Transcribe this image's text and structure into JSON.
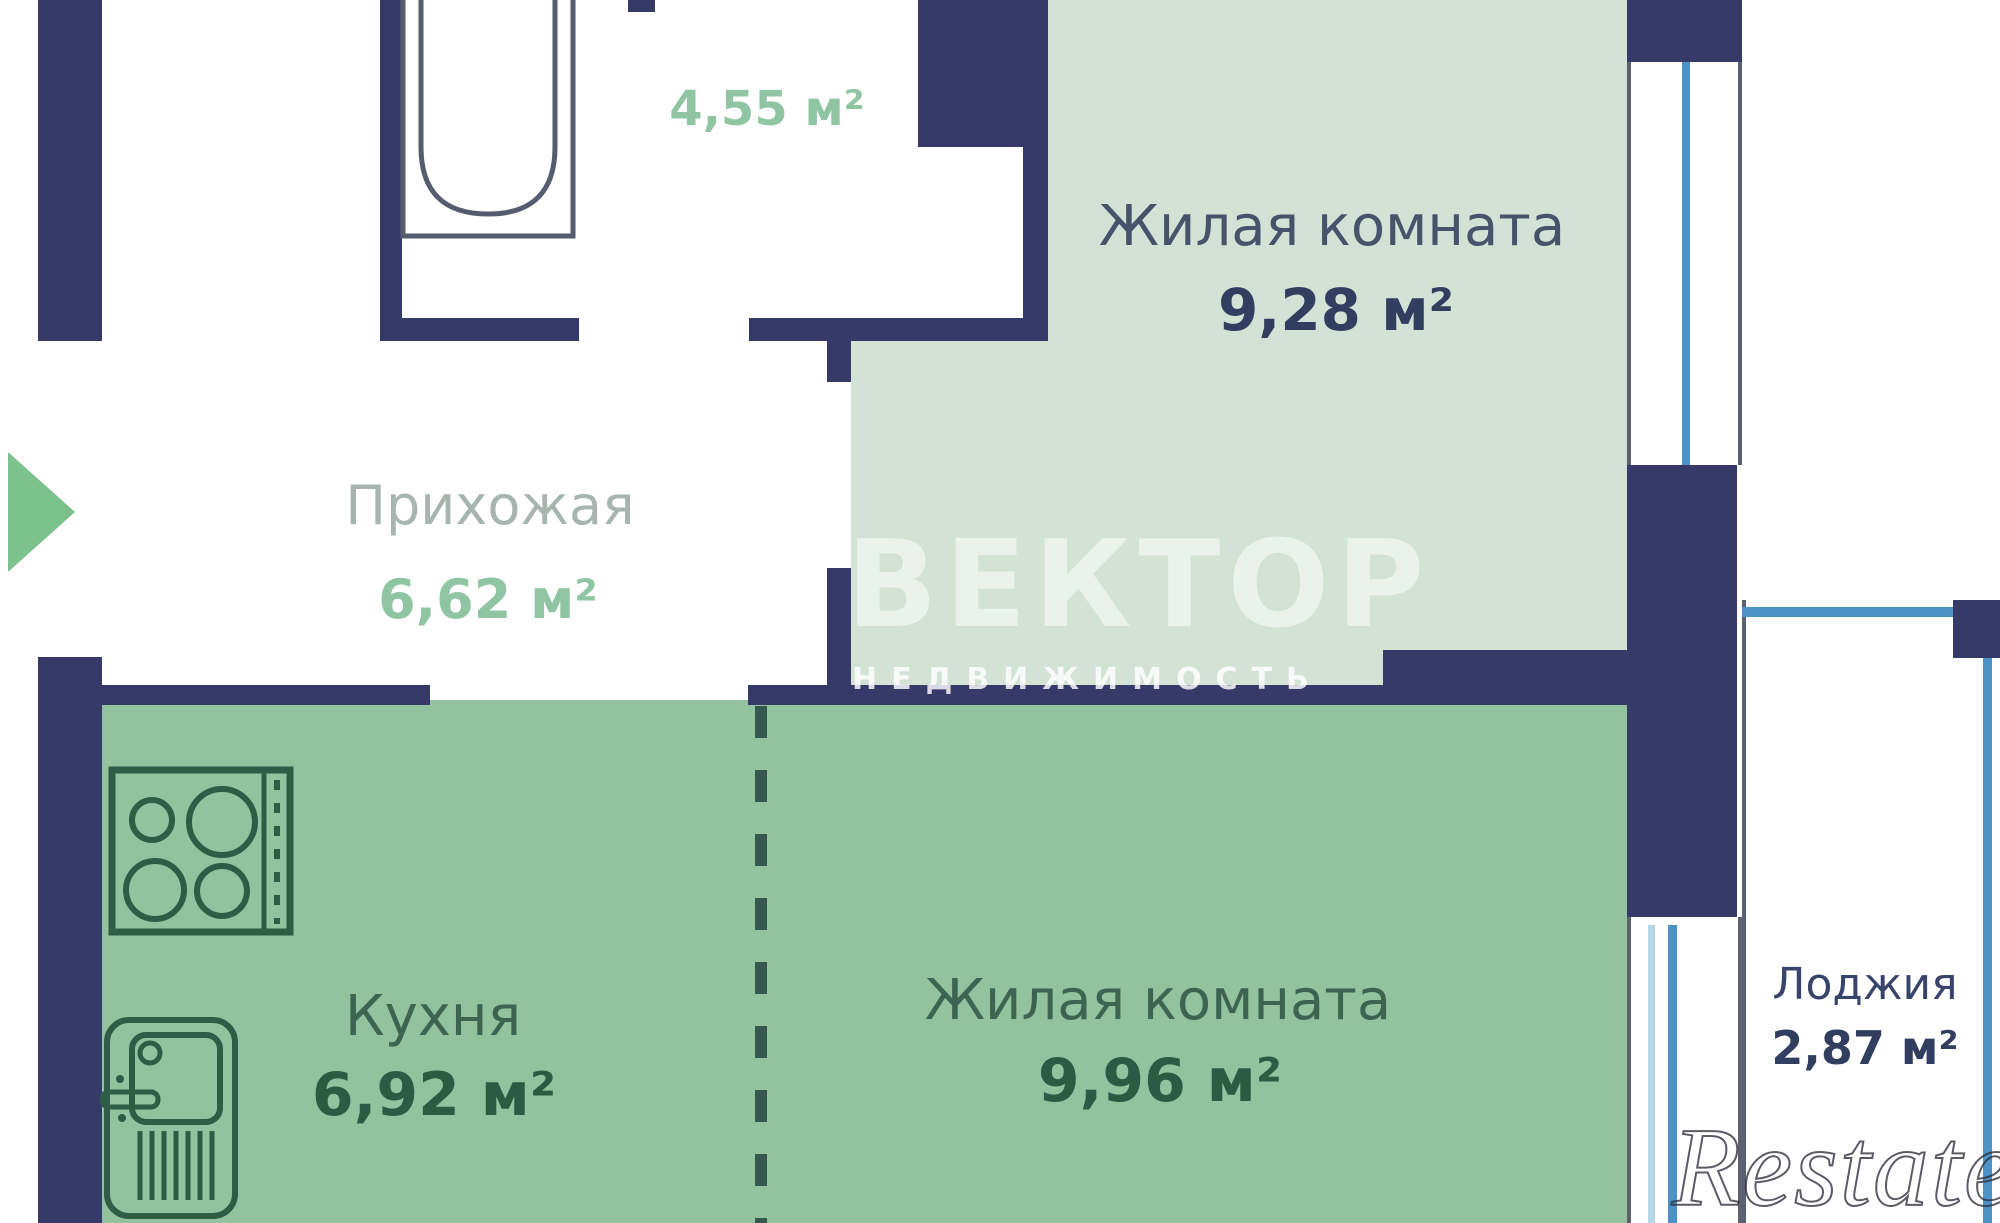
{
  "plan_title": "apartment floor plan",
  "rooms": [
    {
      "id": "bathroom",
      "name": "",
      "area": "4,55 м²"
    },
    {
      "id": "hallway",
      "name": "Прихожая",
      "area": "6,62 м²"
    },
    {
      "id": "living-room-1",
      "name": "Жилая комната",
      "area": "9,28 м²"
    },
    {
      "id": "kitchen",
      "name": "Кухня",
      "area": "6,92 м²"
    },
    {
      "id": "living-room-2",
      "name": "Жилая комната",
      "area": "9,96 м²"
    },
    {
      "id": "loggia",
      "name": "Лоджия",
      "area": "2,87 м²"
    }
  ],
  "watermarks": {
    "brand": "ВЕКТОР",
    "brand_sub": "НЕДВИЖИМОСТЬ",
    "agency": "Restate"
  },
  "icons": {
    "bathtub": "bathtub-icon",
    "stove": "stove-icon",
    "sink": "sink-icon",
    "entrance": "entrance-arrow-icon"
  },
  "colors": {
    "wall": "#363a68",
    "room_pale_green": "#d2e3d6",
    "room_medium_green": "#93c29e",
    "glass_blue": "#4d92c6",
    "glass_light_blue": "#b5d7ea",
    "icon_green": "#2e5c45",
    "entrance_green": "#7cc28e",
    "text_navy": "#323e60",
    "text_dark_green": "#2c5a43",
    "text_light_green": "#90c5a3",
    "text_gray": "#a7b5ae"
  }
}
